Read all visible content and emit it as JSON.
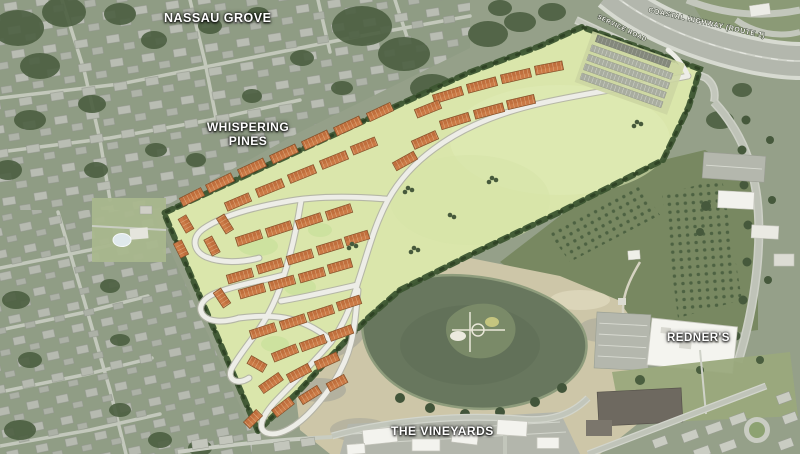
{
  "map": {
    "place_labels": {
      "nassau_grove": "NASSAU GROVE",
      "whispering_pines_line1": "WHISPERING",
      "whispering_pines_line2": "PINES",
      "redners": "REDNER'S",
      "the_vineyards": "THE VINEYARDS"
    },
    "road_labels": {
      "coastal_highway": "COASTAL HIGHWAY (ROUTE 1)",
      "service_road": "SERVICE ROAD"
    },
    "palette": {
      "aerial_base": "#95a089",
      "plan_open_space": "#dae6ab",
      "tree_buffer": "#3c5530",
      "townhouse_roof": "#c06f3d",
      "plan_road": "#edede7",
      "pond_water": "#68775e",
      "disturbed_sand": "#cdc6a8",
      "highway_asphalt": "#b3b7ad"
    }
  }
}
